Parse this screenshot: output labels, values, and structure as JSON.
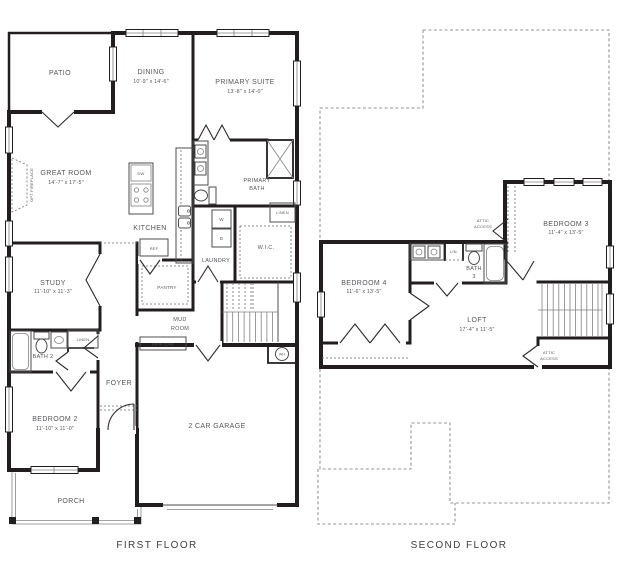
{
  "canvas": {
    "background": "#ffffff",
    "wall_color": "#221e1f",
    "text_color": "#55565a"
  },
  "first_floor": {
    "title": "FIRST FLOOR",
    "rooms": {
      "patio": {
        "name": "PATIO"
      },
      "dining": {
        "name": "DINING",
        "dims": "10'-9\" x 14'-6\""
      },
      "primary_suite": {
        "name": "PRIMARY SUITE",
        "dims": "13'-8\" x 14'-0\""
      },
      "great_room": {
        "name": "GREAT ROOM",
        "dims": "14'-7\" x 17'-5\""
      },
      "kitchen": {
        "name": "KITCHEN"
      },
      "primary_bath": {
        "line1": "PRIMARY",
        "line2": "BATH"
      },
      "wic": {
        "name": "W.I.C."
      },
      "laundry": {
        "name": "LAUNDRY"
      },
      "pantry": {
        "name": "PANTRY"
      },
      "study": {
        "name": "STUDY",
        "dims": "11'-10\" x 11'-3\""
      },
      "mud_room": {
        "line1": "MUD",
        "line2": "ROOM"
      },
      "bath_2": {
        "name": "BATH 2"
      },
      "foyer": {
        "name": "FOYER"
      },
      "bedroom_2": {
        "name": "BEDROOM 2",
        "dims": "11'-10\" x 11'-0\""
      },
      "porch": {
        "name": "PORCH"
      },
      "garage": {
        "name": "2 CAR GARAGE"
      }
    },
    "annotations": {
      "opt_fireplace": "OPT FIREPLACE",
      "dishwasher": "DW",
      "refrigerator": "REF",
      "washer": "W",
      "dryer": "D",
      "linen_primary": "LINEN",
      "linen_bath2": "LINEN",
      "drop_zone": "DROP ZONE",
      "water_heater": "WH"
    }
  },
  "second_floor": {
    "title": "SECOND FLOOR",
    "rooms": {
      "bedroom_3": {
        "name": "BEDROOM 3",
        "dims": "11'-4\" x 13'-5\""
      },
      "bedroom_4": {
        "name": "BEDROOM 4",
        "dims": "11'-6\" x 13'-5\""
      },
      "bath_3": {
        "line1": "BATH",
        "line2": "3"
      },
      "loft": {
        "name": "LOFT",
        "dims": "17'-4\" x 11'-5\""
      }
    },
    "annotations": {
      "attic_access_upper": {
        "line1": "ATTIC",
        "line2": "ACCESS"
      },
      "attic_access_lower": {
        "line1": "ATTIC",
        "line2": "ACCESS"
      },
      "linen": "LIN."
    }
  }
}
